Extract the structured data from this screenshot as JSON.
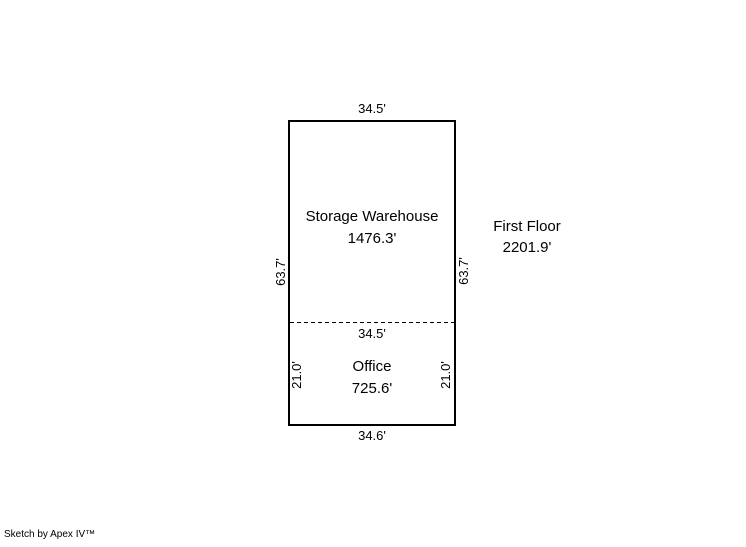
{
  "sketch": {
    "attribution": "Sketch by Apex IV™",
    "colors": {
      "line": "#000000",
      "background": "#ffffff",
      "text": "#000000"
    },
    "first_floor": {
      "label": "First Floor",
      "area": "2201.9'"
    },
    "warehouse": {
      "label": "Storage Warehouse",
      "area": "1476.3'",
      "top_width": "34.5'",
      "left_height": "63.7'",
      "right_height": "63.7'"
    },
    "office": {
      "label": "Office",
      "area": "725.6'",
      "partition_width": "34.5'",
      "bottom_width": "34.6'",
      "left_height": "21.0'",
      "right_height": "21.0'"
    }
  }
}
